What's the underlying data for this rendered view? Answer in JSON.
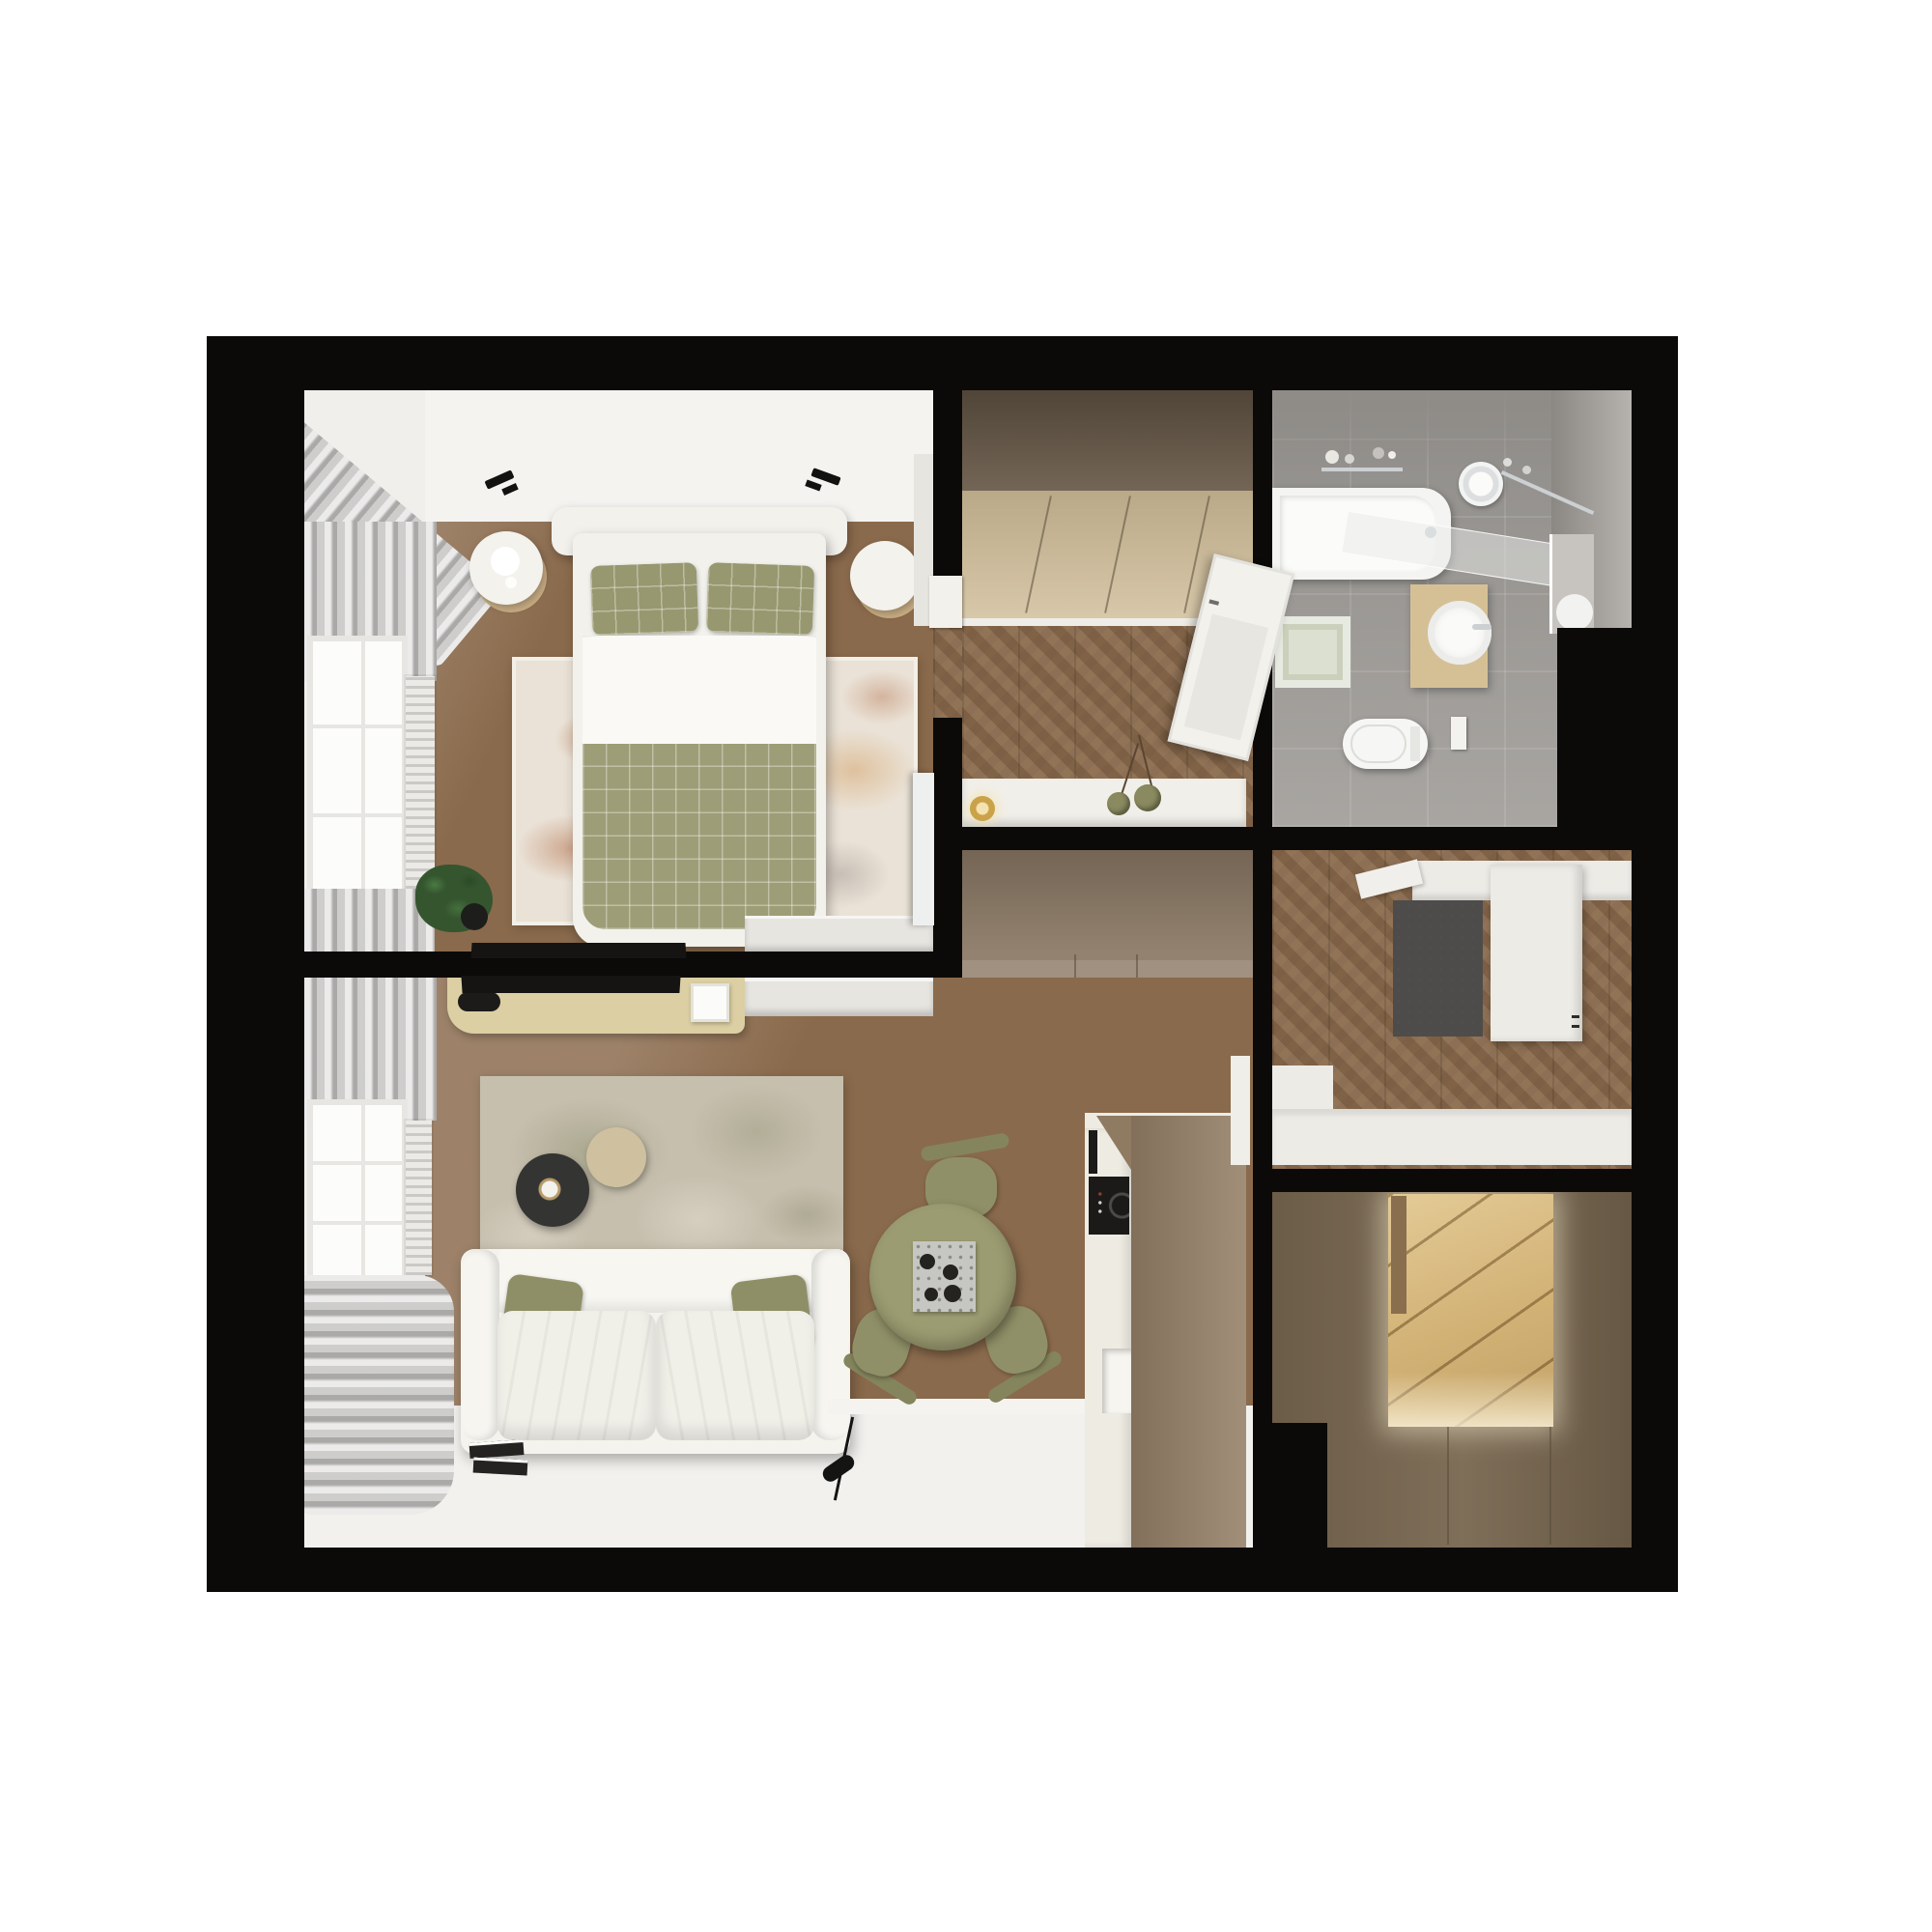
{
  "meta": {
    "title": "Top-down 3D rendered floor plan of a one-bedroom apartment",
    "visible_text": []
  },
  "palette": {
    "pageBg": "#ffffff",
    "wall": "#0b0a09",
    "wood": "#8a6a4c",
    "whiteFloor": "#f2f1ee",
    "ceilingBand": "#f4f3f0",
    "leftStrip": "#f0efec",
    "curtain": "#cfcecc",
    "windowGlass": "#fcfcfa",
    "radiator": "#eceae7",
    "bedFrame": "#f2f1ec",
    "sheet": "#faf9f5",
    "duvetOlive": "#9d9d77",
    "pillowOlive": "#97986f",
    "rugBedroom": "#eae2d6",
    "rugLiving": "#c7bfae",
    "nightstand": "#f3f2ed",
    "nightstandWood": "#c8ad84",
    "dresser": "#e7e5e0",
    "tv": "#151413",
    "sideboard": "#dbcfa3",
    "pictureFrame": "#fbfbf9",
    "sofa": "#f4f3ee",
    "sofaCushion": "#f0efe8",
    "sofaPillow": "#8e8f66",
    "coffeeTableDark": "#343433",
    "coffeeTableTan": "#cfc1a0",
    "tableOlive": "#9c9c72",
    "chairOlive": "#8f9067",
    "chairArc": "#84855d",
    "tray": "#c6c6c2",
    "cup": "#24231f",
    "kitchenFace": "#eeebe3",
    "kitchenBlock": "#97826a",
    "cooktop": "#1b1a19",
    "pillar": "#f0eee9",
    "wardrobeTop": "#6b5c4b",
    "wardrobeFront": "#cfbc97",
    "consoleTable": "#f1efe9",
    "lampGold": "#c9a24a",
    "vase": "#8a8a60",
    "centralBlock": "#8d7b67",
    "bathFloor": "#a3a09c",
    "bathWall": "#918e8a",
    "tub": "#f4f4f2",
    "tubInner": "#fbfbf9",
    "mirror": "#c7c4c0",
    "vanity": "#d5c096",
    "sink": "#fafaf8",
    "toilet": "#f6f6f4",
    "bathMat": "#dce0d0",
    "chrome": "#ccd0d2",
    "doormat": "#4e4c4a",
    "entryWhite": "#edebe6",
    "closet": "#786750",
    "door": "#f2f1ec",
    "doorGlass": "#e7e6e1",
    "plant": "#35552f",
    "pot": "#1d1d1c",
    "spot": "#121211",
    "book": "#242322",
    "mirrorLean": "#eef0ef",
    "baseboard": "#f4f3f0"
  },
  "rooms": [
    {
      "id": "bedroom"
    },
    {
      "id": "hallway"
    },
    {
      "id": "bathroom"
    },
    {
      "id": "entry-hall"
    },
    {
      "id": "walk-in-closet"
    },
    {
      "id": "living-room"
    },
    {
      "id": "kitchen"
    },
    {
      "id": "dining-area"
    }
  ],
  "furniture": {
    "bedroom": [
      "double-bed",
      "plaid-pillows",
      "plaid-duvet",
      "nightstand-left",
      "nightstand-right",
      "area-rug",
      "potted-plant",
      "tv",
      "low-dresser",
      "leaning-mirror",
      "curtains",
      "window",
      "radiator",
      "ceiling-spotlights"
    ],
    "hallway": [
      "built-in-wardrobe",
      "console-table",
      "table-lamp",
      "vases-with-branches",
      "open-door"
    ],
    "bathroom": [
      "bathtub",
      "shower-head",
      "glass-screen",
      "towel-rail",
      "vanity-with-round-sink",
      "wall-mirror",
      "toilet",
      "flush-panel",
      "bath-mat",
      "toiletry-shelf",
      "ceiling-lights"
    ],
    "entry_hall": [
      "doormat",
      "tall-white-cabinet",
      "wall-shelf",
      "coat-rack",
      "bench"
    ],
    "walk_in_closet": [
      "wardrobe-cabinets",
      "lighted-shelf-niche"
    ],
    "living_room": [
      "sofa",
      "seat-cushions",
      "olive-pillows",
      "coffee-table-dark",
      "coffee-table-tan",
      "area-rug",
      "media-sideboard",
      "tv",
      "picture-frame",
      "remote-controls",
      "books",
      "floor-lamp",
      "curtains",
      "window",
      "radiator"
    ],
    "kitchen": [
      "tall-cabinet-block",
      "induction-cooktop",
      "vent-strip",
      "open-niche",
      "counter-edge",
      "pillar"
    ],
    "dining_area": [
      "round-table",
      "three-chairs",
      "serving-tray-with-cups"
    ]
  }
}
